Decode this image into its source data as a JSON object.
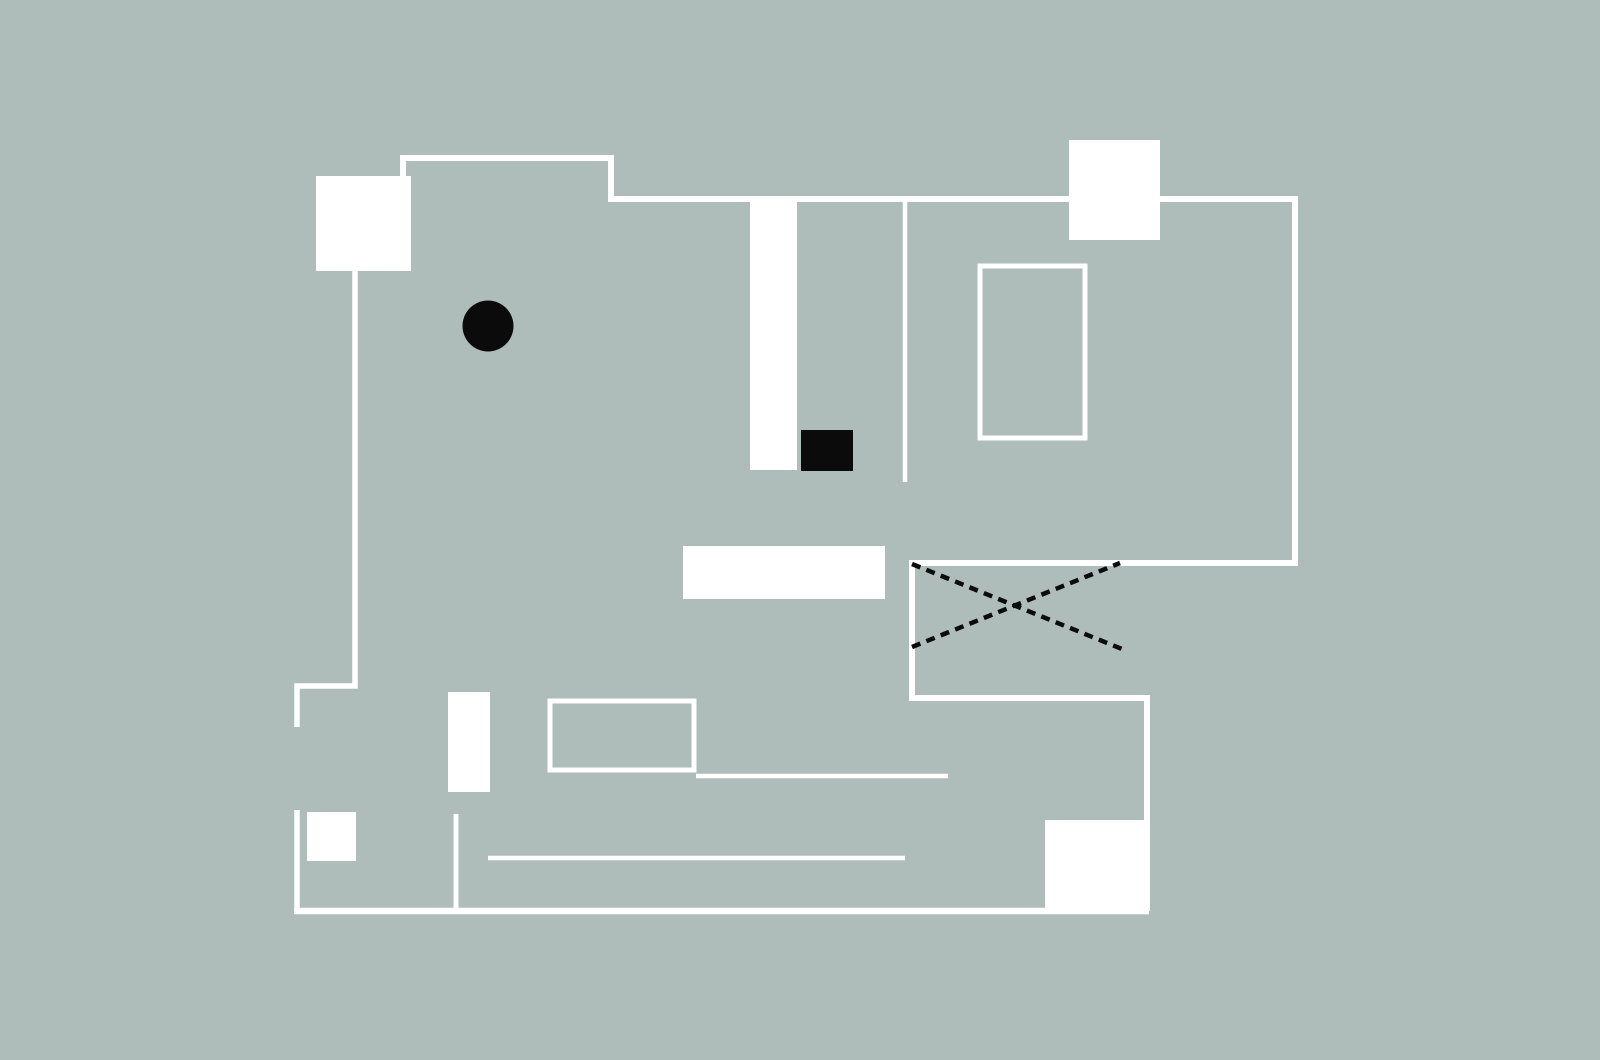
{
  "canvas": {
    "width": 1600,
    "height": 1060,
    "background": "#aebcba"
  },
  "palette": {
    "wall": "#ffffff",
    "ink": "#0b0b0b"
  },
  "diagram": {
    "kind": "floor-plan",
    "shapes": [
      {
        "name": "wall-main-outline",
        "type": "polyline",
        "stroke": "wall",
        "width": 6,
        "points": [
          [
            403,
            177
          ],
          [
            403,
            158
          ],
          [
            611,
            158
          ],
          [
            611,
            199
          ],
          [
            1295,
            199
          ],
          [
            1295,
            563
          ],
          [
            912,
            563
          ],
          [
            912,
            698
          ],
          [
            1147,
            698
          ],
          [
            1147,
            822
          ]
        ]
      },
      {
        "name": "wall-left-upper",
        "type": "polyline",
        "stroke": "wall",
        "width": 5.5,
        "points": [
          [
            355,
            271
          ],
          [
            355,
            686
          ],
          [
            297,
            686
          ],
          [
            297,
            727
          ]
        ]
      },
      {
        "name": "wall-left-lower",
        "type": "polyline",
        "stroke": "wall",
        "width": 5.5,
        "points": [
          [
            297,
            810
          ],
          [
            297,
            911
          ]
        ]
      },
      {
        "name": "wall-bottom",
        "type": "polyline",
        "stroke": "wall",
        "width": 6.5,
        "points": [
          [
            294,
            911
          ],
          [
            1149,
            911
          ]
        ]
      },
      {
        "name": "wall-stub-bottom-middle",
        "type": "polyline",
        "stroke": "wall",
        "width": 5,
        "points": [
          [
            456,
            814
          ],
          [
            456,
            911
          ]
        ]
      },
      {
        "name": "partition-line-vertical",
        "type": "line",
        "stroke": "wall",
        "width": 4.5,
        "x1": 905,
        "y1": 199,
        "x2": 905,
        "y2": 482
      },
      {
        "name": "partition-line-middle",
        "type": "line",
        "stroke": "wall",
        "width": 4.5,
        "x1": 696,
        "y1": 776,
        "x2": 948,
        "y2": 776
      },
      {
        "name": "partition-line-lower",
        "type": "line",
        "stroke": "wall",
        "width": 4.5,
        "x1": 488,
        "y1": 858,
        "x2": 905,
        "y2": 858
      },
      {
        "name": "room-outline-right",
        "type": "rect",
        "stroke": "wall",
        "width": 5,
        "fill": null,
        "x": 980,
        "y": 266,
        "w": 105,
        "h": 172
      },
      {
        "name": "room-outline-bottom",
        "type": "rect",
        "stroke": "wall",
        "width": 5,
        "fill": null,
        "x": 550,
        "y": 701,
        "w": 144,
        "h": 69
      },
      {
        "name": "block-top-left",
        "type": "rect",
        "fill": "wall",
        "x": 316,
        "y": 176,
        "w": 95,
        "h": 95
      },
      {
        "name": "block-top-right",
        "type": "rect",
        "fill": "wall",
        "x": 1069,
        "y": 140,
        "w": 91,
        "h": 100
      },
      {
        "name": "block-column-center",
        "type": "rect",
        "fill": "wall",
        "x": 750,
        "y": 200,
        "w": 47,
        "h": 270
      },
      {
        "name": "block-bar-center",
        "type": "rect",
        "fill": "wall",
        "x": 683,
        "y": 546,
        "w": 202,
        "h": 53
      },
      {
        "name": "block-bar-lower-left",
        "type": "rect",
        "fill": "wall",
        "x": 448,
        "y": 692,
        "w": 42,
        "h": 100
      },
      {
        "name": "block-square-lower-left",
        "type": "rect",
        "fill": "wall",
        "x": 307,
        "y": 812,
        "w": 49,
        "h": 49
      },
      {
        "name": "block-square-bottom-right",
        "type": "rect",
        "fill": "wall",
        "x": 1045,
        "y": 820,
        "w": 105,
        "h": 91
      },
      {
        "name": "dashed-cross-line-1",
        "type": "line",
        "stroke": "ink",
        "width": 4.5,
        "dash": "9 6.5",
        "x1": 912,
        "y1": 564,
        "x2": 1122,
        "y2": 649
      },
      {
        "name": "dashed-cross-line-2",
        "type": "line",
        "stroke": "ink",
        "width": 4.5,
        "dash": "9 6.5",
        "x1": 912,
        "y1": 647,
        "x2": 1120,
        "y2": 563
      },
      {
        "name": "marker-dot",
        "type": "circle",
        "fill": "ink",
        "cx": 488,
        "cy": 326,
        "r": 25.5
      },
      {
        "name": "marker-block",
        "type": "rect",
        "fill": "ink",
        "x": 801,
        "y": 430,
        "w": 52,
        "h": 41
      }
    ]
  }
}
